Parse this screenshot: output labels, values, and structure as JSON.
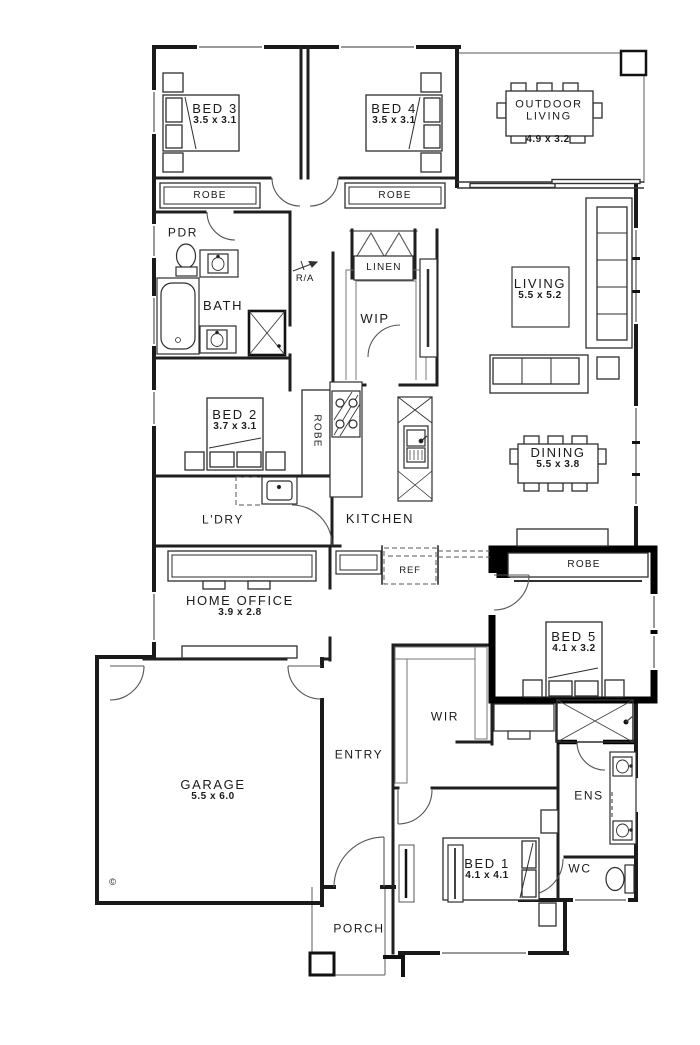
{
  "rooms": {
    "bed3": {
      "name": "BED 3",
      "dims": "3.5 x 3.1"
    },
    "bed4": {
      "name": "BED 4",
      "dims": "3.5 x 3.1"
    },
    "outdoor_living": {
      "name": "OUTDOOR LIVING",
      "line1": "OUTDOOR",
      "line2": "LIVING",
      "dims": "4.9 x 3.2"
    },
    "robe_bed3": {
      "name": "ROBE"
    },
    "robe_bed4": {
      "name": "ROBE"
    },
    "pdr": {
      "name": "PDR"
    },
    "bath": {
      "name": "BATH"
    },
    "return_air": {
      "name": "R/A"
    },
    "linen": {
      "name": "LINEN"
    },
    "wip": {
      "name": "WIP"
    },
    "living": {
      "name": "LIVING",
      "dims": "5.5 x 5.2"
    },
    "bed2": {
      "name": "BED 2",
      "dims": "3.7 x 3.1"
    },
    "robe_bed2": {
      "name": "ROBE"
    },
    "laundry": {
      "name": "L'DRY"
    },
    "kitchen": {
      "name": "KITCHEN"
    },
    "dining": {
      "name": "DINING",
      "dims": "5.5 x 3.8"
    },
    "fridge": {
      "name": "REF"
    },
    "home_office": {
      "name": "HOME OFFICE",
      "dims": "3.9 x 2.8"
    },
    "robe_bed5": {
      "name": "ROBE"
    },
    "bed5": {
      "name": "BED 5",
      "dims": "4.1 x 3.2"
    },
    "garage": {
      "name": "GARAGE",
      "dims": "5.5 x 6.0"
    },
    "entry": {
      "name": "ENTRY"
    },
    "wir": {
      "name": "WIR"
    },
    "ens": {
      "name": "ENS"
    },
    "bed1": {
      "name": "BED 1",
      "dims": "4.1 x 4.1"
    },
    "wc": {
      "name": "WC"
    },
    "porch": {
      "name": "PORCH"
    }
  },
  "annotations": {
    "copyright": "©"
  },
  "colors": {
    "wall": "#1a1a1a",
    "highlight_wall": "#000000",
    "furniture": "#3a3a3a",
    "thin": "#666666"
  }
}
